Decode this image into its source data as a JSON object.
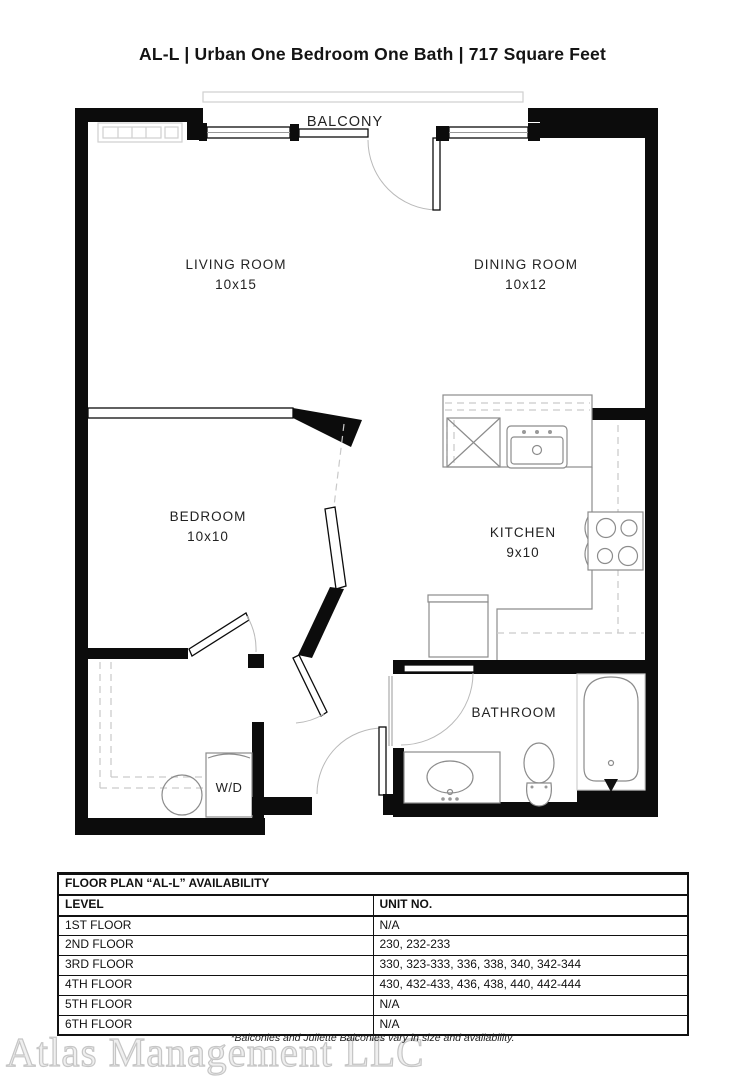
{
  "header": {
    "title": "AL-L | Urban One Bedroom One Bath | 717  Square Feet"
  },
  "floorplan": {
    "balcony_label": "BALCONY",
    "rooms": {
      "living": {
        "label": "LIVING ROOM",
        "dims": "10x15"
      },
      "dining": {
        "label": "DINING ROOM",
        "dims": "10x12"
      },
      "bedroom": {
        "label": "BEDROOM",
        "dims": "10x10"
      },
      "kitchen": {
        "label": "KITCHEN",
        "dims": "9x10"
      },
      "bathroom": {
        "label": "BATHROOM",
        "dims": ""
      }
    },
    "wd_label": "W/D"
  },
  "availability": {
    "title": "FLOOR PLAN “AL-L” AVAILABILITY",
    "columns": [
      "LEVEL",
      "UNIT NO."
    ],
    "rows": [
      {
        "level": "1ST FLOOR",
        "units": "N/A"
      },
      {
        "level": "2ND FLOOR",
        "units": "230, 232-233"
      },
      {
        "level": "3RD FLOOR",
        "units": "330, 323-333, 336, 338, 340, 342-344"
      },
      {
        "level": "4TH FLOOR",
        "units": "430, 432-433, 436, 438, 440, 442-444"
      },
      {
        "level": "5TH FLOOR",
        "units": "N/A"
      },
      {
        "level": "6TH FLOOR",
        "units": "N/A"
      }
    ]
  },
  "footnote": "*Balconies and Juliette Balconies vary in size and availability.",
  "watermark": "Atlas Management LLC",
  "colors": {
    "wall": "#0c0c0c",
    "fixture": "#8c8c8c",
    "dashed": "#c9c9c9"
  }
}
